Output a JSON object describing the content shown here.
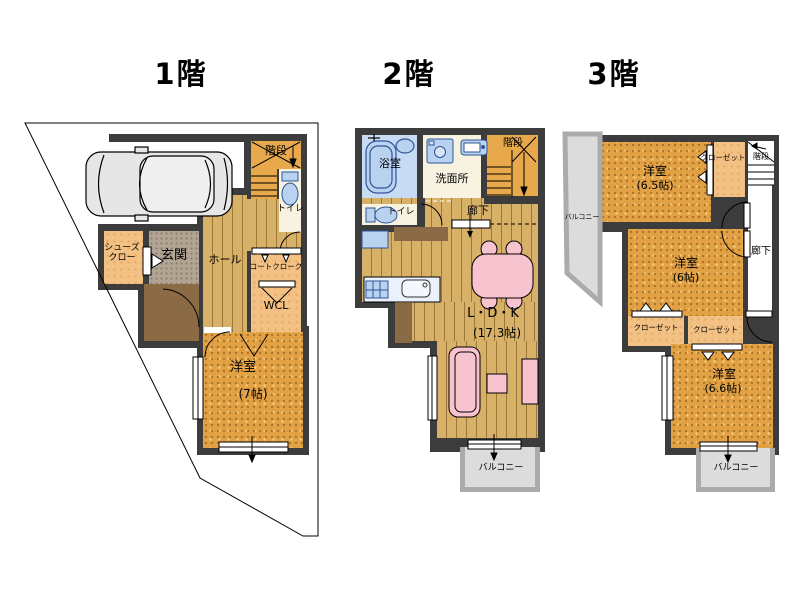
{
  "floors": {
    "f1": {
      "title": "1階",
      "stairs": "階段",
      "toilet": "トイレ",
      "shoe_closet_line1": "シューズ",
      "shoe_closet_line2": "クロー",
      "entrance": "玄関",
      "hall": "ホール",
      "coat_closet": "コートクローク",
      "wcl": "WCL",
      "room": "洋室",
      "room_size": "(7帖)"
    },
    "f2": {
      "title": "2階",
      "bath": "浴室",
      "washroom": "洗面所",
      "stairs": "階段",
      "toilet": "トイレ",
      "corridor": "廊下",
      "ldk": "L・D・K",
      "ldk_size": "(17.3帖)",
      "balcony": "バルコニー"
    },
    "f3": {
      "title": "3階",
      "room1": "洋室",
      "room1_size": "(6.5帖)",
      "closet_top": "クローゼット",
      "stairs": "階段",
      "balcony_left": "バルコニー",
      "corridor": "廊下",
      "room2": "洋室",
      "room2_size": "(6帖)",
      "closet_left": "クローゼット",
      "closet_right": "クローゼット",
      "room3": "洋室",
      "room3_size": "(6.6帖)",
      "balcony_bottom": "バルコニー"
    }
  },
  "icons": {
    "car": "car-icon",
    "bathtub": "bathtub-icon",
    "toilet": "toilet-icon",
    "washer": "washing-machine-icon",
    "sink": "sink-icon",
    "kitchen": "kitchen-counter-icon",
    "dining_table": "dining-table-icon",
    "sofa": "sofa-icon"
  },
  "palette": {
    "wall": "#3C3C3C",
    "tatami_floor": "#E2A144",
    "wood_floor": "#D8B168",
    "closet_peach": "#F4C184",
    "sanitary_cream": "#F7F3E0",
    "bath_blue": "#C7DBF4",
    "fixture_blue": "#B9D2F0",
    "furniture_pink": "#F7C3CF",
    "balcony_gray": "#DCDCDC",
    "balcony_wall_gray": "#ABABAB",
    "entrance_gray": "#B3A593",
    "porch_brown": "#8A6B45"
  }
}
